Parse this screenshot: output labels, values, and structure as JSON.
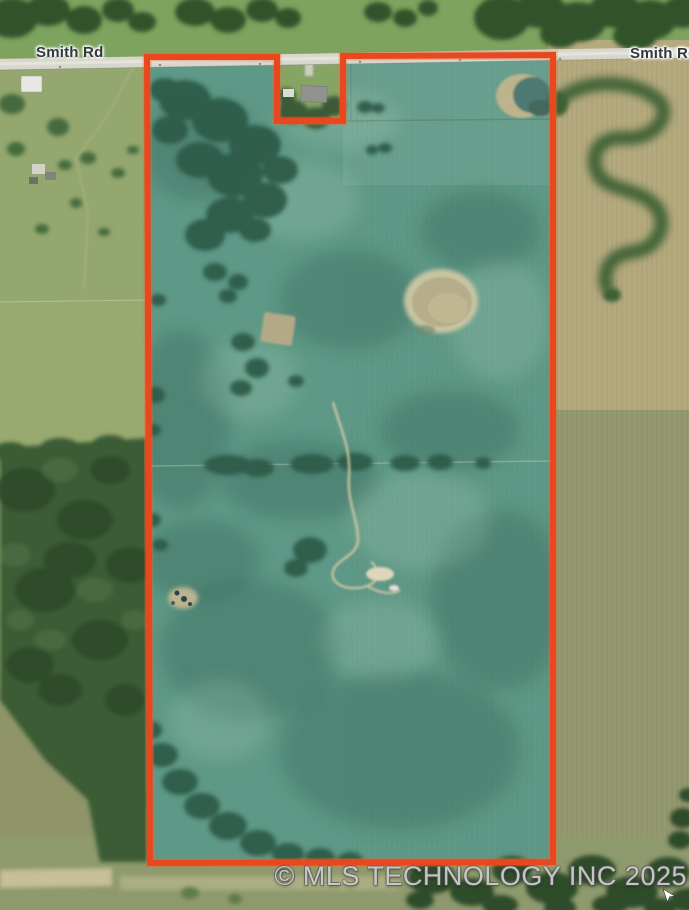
{
  "map": {
    "kind": "aerial-satellite-parcel-view",
    "road_labels": {
      "left": "Smith Rd",
      "right": "Smith Rd"
    },
    "watermark": {
      "text": "© MLS TECHNOLOGY INC 2025"
    },
    "parcel": {
      "outline_color": "#e8481f",
      "outline_glow": "rgba(243,105,48,0.38)",
      "outline_width": 6,
      "outline_points": "147,57 277,57 277,121 343,121 343,56 553,55 553,862 150,863"
    },
    "palette": {
      "parcel_field_teal": "#5e9886",
      "west_pasture": "#93a76e",
      "north_grass": "#7da35e",
      "east_field_upper_tan": "#b5aa7e",
      "east_field_lower_olive": "#95996f",
      "south_strip": "#8e9a6d",
      "forest": "#3a5c36",
      "tree_dark": "#2f5b49",
      "road_surface": "#d8d7cd",
      "dry_pond": "#b6ad8a",
      "stock_pond_water": "#4d7972"
    },
    "features": [
      "smith-road",
      "parcel-outline",
      "homestead-exclusion-notch",
      "stock-pond",
      "dry-pond",
      "seasonal-creek",
      "mid-parcel-tree-row",
      "west-forest",
      "east-tree-line",
      "south-tree-band",
      "west-homesteads",
      "corral",
      "mouse-cursor"
    ]
  }
}
